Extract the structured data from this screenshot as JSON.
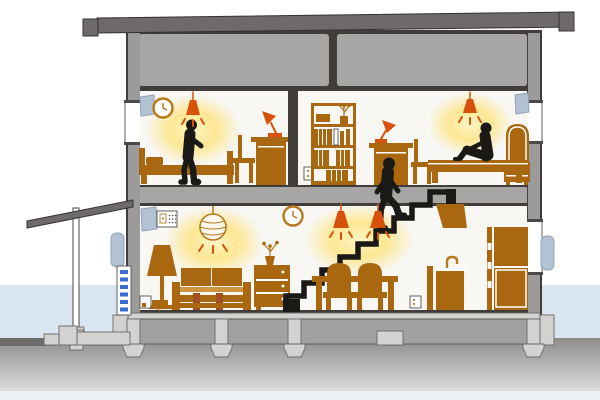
{
  "meta": {
    "scene": "cutaway-cross-section-of-two-story-house",
    "floors": 2,
    "people_count": 3,
    "lit_lamps_count": 5,
    "rooms": [
      "bedroom-left",
      "bedroom-right",
      "living-room",
      "dining-area",
      "kitchen",
      "attic",
      "porch"
    ]
  },
  "elements": {
    "fixtures": [
      "pendant-cone-lamp",
      "paper-lantern-lamp",
      "floor-lamp",
      "desk-lamp",
      "wall-clock",
      "wall-vent",
      "exterior-vent-unit",
      "control-panel",
      "power-outlet",
      "range-hood",
      "kitchen-sink",
      "refrigerator",
      "ventilation-dashed-duct"
    ],
    "furniture": [
      "bed",
      "desk",
      "chair",
      "bookshelf",
      "sofa",
      "chest-of-drawers",
      "dining-table",
      "dining-chair",
      "headboard-cabinet",
      "potted-plant"
    ],
    "people": [
      "person-standing-bedroom-left",
      "person-sitting-bedroom-right",
      "person-climbing-stairs"
    ]
  },
  "colors": {
    "roof": "#6e6a69",
    "outline": "#403d3b",
    "structure": "#a8a6a5",
    "wall": "#9d9b9a",
    "interior": "#f8f7f4",
    "furniture": "#a9670f",
    "furniture-line": "#b5791b",
    "furniture-light": "#cf9440",
    "wood-red": "#a34f24",
    "accent-lamp": "#d8510b",
    "glow-core": "#fff7c9",
    "glow-mid": "#ffe170",
    "person": "#1a1916",
    "vent": "#b3c2d3",
    "vent-edge": "#93a3b8",
    "dash": "#3a6bd0",
    "sky-band": "#d9e5f1",
    "ground-top": "#8f8d8b",
    "ground-bottom": "#dcdbd9",
    "foundation": "#a3a19f",
    "foundation-light": "#d4d2d0",
    "bottom-strip": "#edf1f6",
    "walkway": "#6f6d6c",
    "window-frame": "#4a4a4a",
    "white": "#ffffff"
  }
}
